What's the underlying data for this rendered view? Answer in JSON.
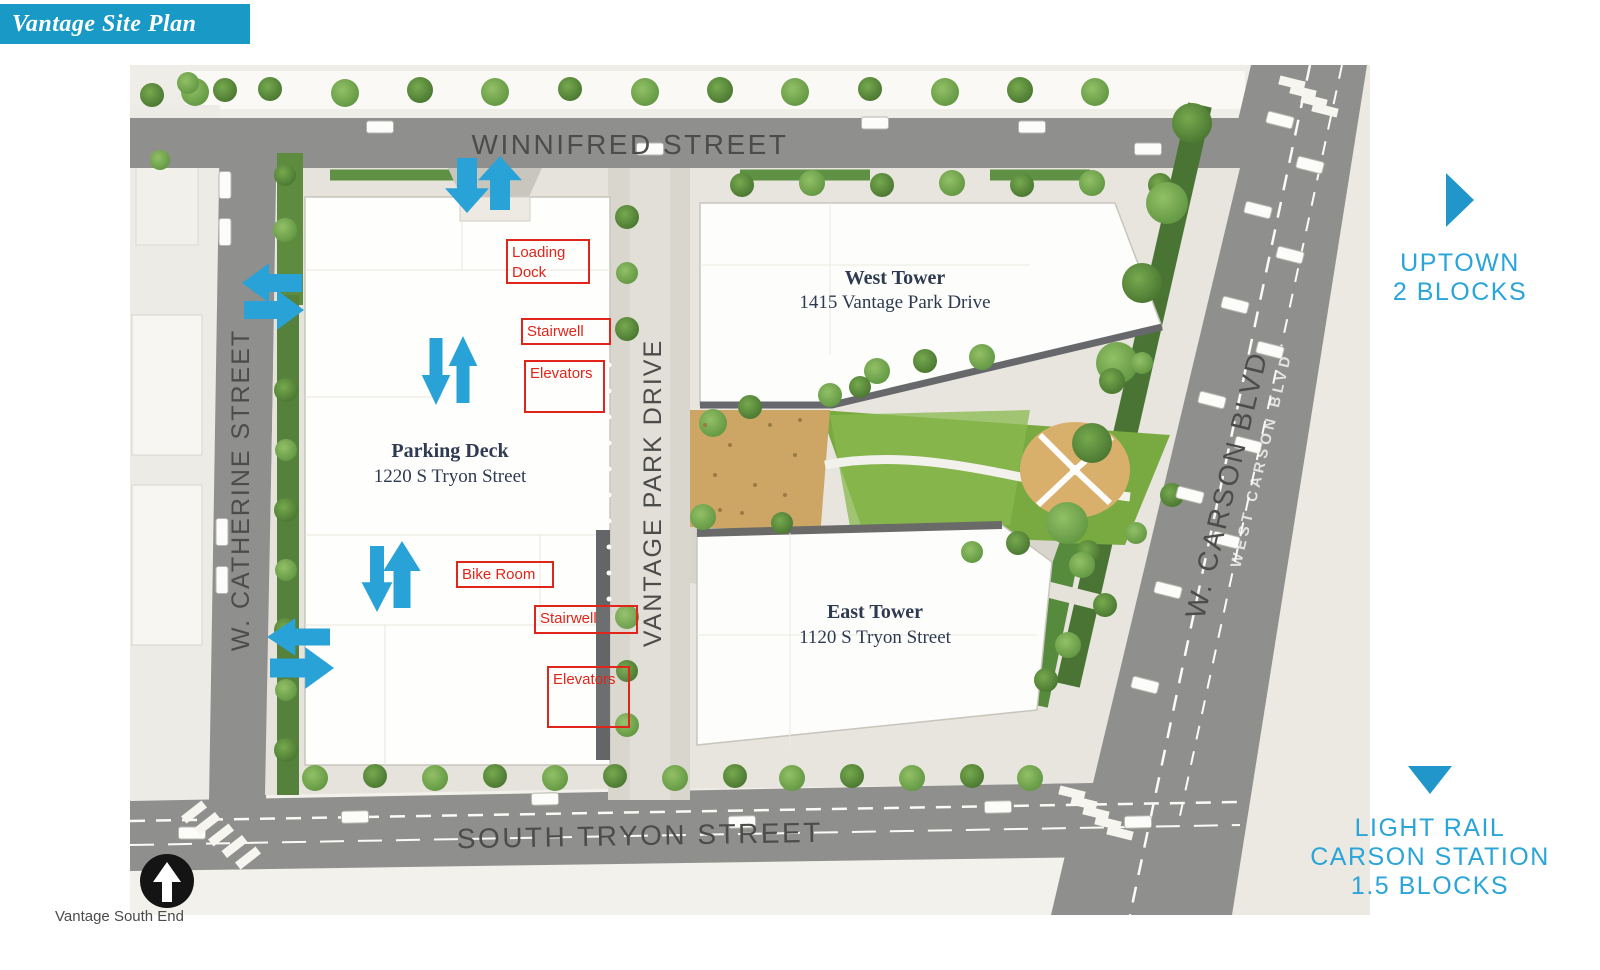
{
  "header": {
    "title": "Vantage Site Plan"
  },
  "footer": {
    "caption": "Vantage South End"
  },
  "colors": {
    "banner_blue": "#1899C6",
    "accent_blue": "#29A3D7",
    "label_red": "#E0251B",
    "street_gray": "#8F8F8D",
    "street_text_gray": "#4C4C4A",
    "building_text_navy": "#2E3A51",
    "map_background": "#F3F1EB",
    "lawn_green": "#79AA42",
    "tree_green": "#5F9440"
  },
  "directions": {
    "uptown": {
      "icon": "triangle-right",
      "lines": [
        "UPTOWN",
        "2 BLOCKS"
      ]
    },
    "light_rail": {
      "icon": "triangle-down",
      "lines": [
        "LIGHT RAIL",
        "CARSON STATION",
        "1.5 BLOCKS"
      ]
    }
  },
  "map": {
    "north_indicator": "north-arrow",
    "streets": {
      "winnifred": "WINNIFRED STREET",
      "catherine": "W. CATHERINE STREET",
      "south_tryon": "SOUTH TRYON STREET",
      "vantage_park": "VANTAGE PARK DRIVE",
      "carson": "W. CARSON BLVD",
      "carson_road_paint": "WEST CARSON BLVD"
    },
    "buildings": {
      "parking_deck": {
        "name": "Parking Deck",
        "address": "1220 S Tryon Street"
      },
      "west_tower": {
        "name": "West Tower",
        "address": "1415 Vantage Park Drive"
      },
      "east_tower": {
        "name": "East Tower",
        "address": "1120 S Tryon Street"
      }
    },
    "unit_labels": [
      {
        "text": "Loading Dock",
        "x": 506,
        "y": 239,
        "w": 84,
        "h": 45
      },
      {
        "text": "Stairwell",
        "x": 521,
        "y": 318,
        "w": 90,
        "h": 27
      },
      {
        "text": "Elevators",
        "x": 524,
        "y": 360,
        "w": 81,
        "h": 53
      },
      {
        "text": "Bike Room",
        "x": 456,
        "y": 561,
        "w": 98,
        "h": 27
      },
      {
        "text": "Stairwell",
        "x": 534,
        "y": 605,
        "w": 104,
        "h": 29
      },
      {
        "text": "Elevators",
        "x": 547,
        "y": 666,
        "w": 83,
        "h": 62
      }
    ],
    "access_arrows": [
      {
        "dir": "down",
        "cx": 337,
        "from": 93,
        "to": 148,
        "w": 20
      },
      {
        "dir": "up",
        "cx": 370,
        "from": 145,
        "to": 91,
        "w": 20
      },
      {
        "dir": "left",
        "cy": 218,
        "from": 172,
        "to": 112,
        "w": 18
      },
      {
        "dir": "right",
        "cy": 245,
        "from": 114,
        "to": 174,
        "w": 18
      },
      {
        "dir": "down",
        "cx": 306,
        "from": 273,
        "to": 340,
        "w": 13
      },
      {
        "dir": "up",
        "cx": 333,
        "from": 338,
        "to": 271,
        "w": 13
      },
      {
        "dir": "down",
        "cx": 247,
        "from": 481,
        "to": 547,
        "w": 14
      },
      {
        "dir": "up",
        "cx": 272,
        "from": 543,
        "to": 476,
        "w": 17
      },
      {
        "dir": "left",
        "cy": 572,
        "from": 200,
        "to": 137,
        "w": 17
      },
      {
        "dir": "right",
        "cy": 603,
        "from": 140,
        "to": 204,
        "w": 19
      }
    ]
  }
}
